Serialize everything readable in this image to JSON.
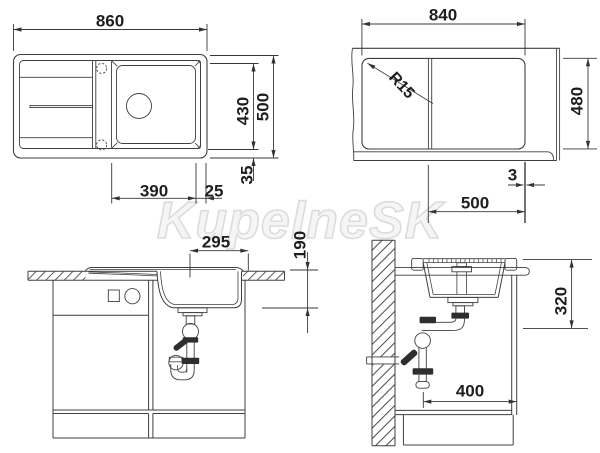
{
  "watermark": {
    "text": "KupelneSK"
  },
  "colors": {
    "background": "#ffffff",
    "line": "#3f3f3f",
    "dimension_text": "#1e1e1e",
    "watermark": "#dcdcdc",
    "fitting_dark": "#2e2e2e"
  },
  "views": {
    "top_view": {
      "name": "sink top plan view",
      "dim_overall_width": "860",
      "dim_inner_depth": "430",
      "dim_overall_depth": "500",
      "dim_bowl_width": "390",
      "dim_bowl_edge_offset": "25",
      "dim_rim_offset": "35"
    },
    "cutout_view": {
      "name": "worktop cutout plan view",
      "dim_cutout_width": "840",
      "dim_corner_radius": "R15",
      "dim_cutout_depth": "480",
      "dim_edge_gap": "3",
      "dim_bowl_cutout": "500"
    },
    "front_view": {
      "name": "front elevation with cabinet",
      "dim_bowl_position": "295",
      "dim_bowl_depth": "190"
    },
    "side_view": {
      "name": "side elevation with wall",
      "dim_install_clearance": "320",
      "dim_cabinet_depth": "400"
    }
  }
}
